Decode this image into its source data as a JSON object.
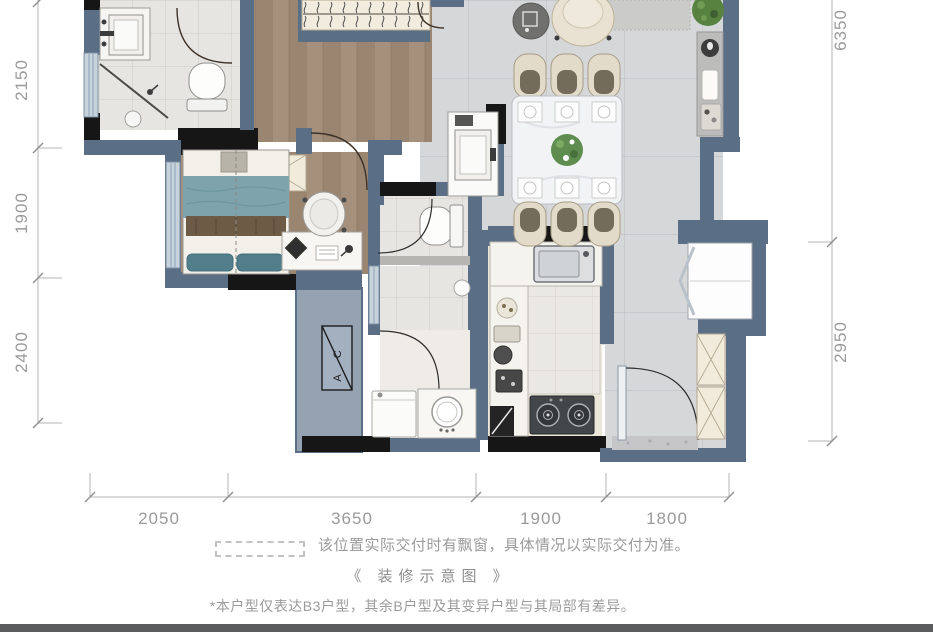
{
  "dimensions": {
    "left": [
      "2150",
      "1900",
      "2400"
    ],
    "right": [
      "6350",
      "2950"
    ],
    "bottom": [
      "2050",
      "3650",
      "1900",
      "1800"
    ]
  },
  "annotations": {
    "legend_text": "该位置实际交付时有飘窗，具体情况以实际交付为准。",
    "caption": "《 装修示意图 》",
    "footnote": "*本户型仅表达B3户型，其余B户型及其变异户型与其局部有差异。",
    "ac_label": "AC"
  },
  "colors": {
    "wall": "#5A6E86",
    "structural_wall": "#161616",
    "window_glass": "#C6D2DC",
    "wood_floor": "#A18B75",
    "bath_tile": "#E7E5E1",
    "marble_tile": "#D6D7D9",
    "kitchen_floor": "#ECE7DB",
    "bed_teal": "#7FA3AD",
    "dimension_text": "#9A9A9A",
    "note_text": "#9B9B9B",
    "footer_bar": "#5A5C5E"
  }
}
